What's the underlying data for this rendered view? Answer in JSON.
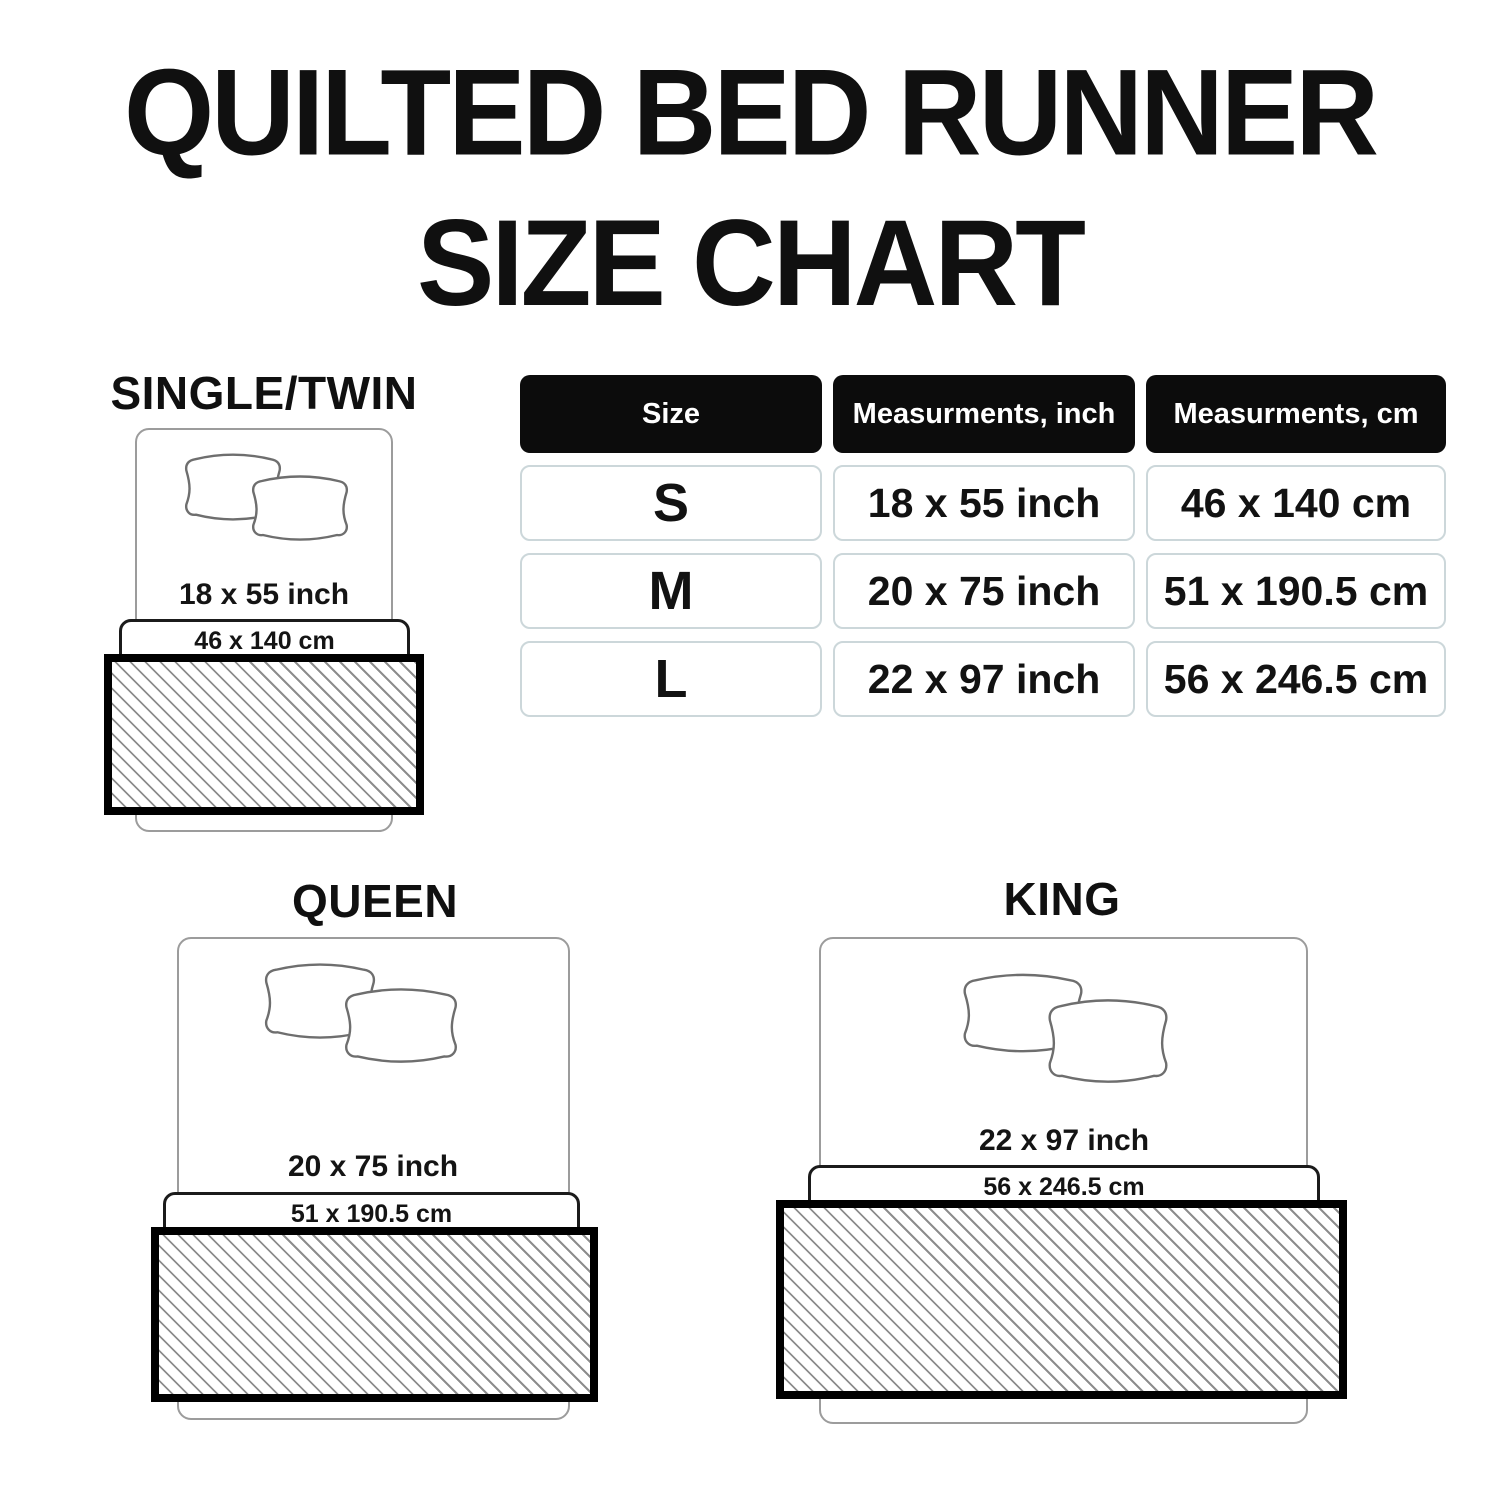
{
  "title": {
    "line1": "QUILTED BED RUNNER",
    "line2": "SIZE CHART"
  },
  "size_table": {
    "headers": [
      "Size",
      "Measurments, inch",
      "Measurments, cm"
    ],
    "rows": [
      {
        "size": "S",
        "inch": "18 x 55 inch",
        "cm": "46 x 140 cm"
      },
      {
        "size": "M",
        "inch": "20 x 75 inch",
        "cm": "51 x 190.5 cm"
      },
      {
        "size": "L",
        "inch": "22 x 97 inch",
        "cm": "56 x 246.5 cm"
      }
    ]
  },
  "diagrams": [
    {
      "label": "SINGLE/TWIN",
      "inch_label": "18 x 55 inch",
      "cm_label": "46 x 140 cm"
    },
    {
      "label": "QUEEN",
      "inch_label": "20 x 75 inch",
      "cm_label": "51 x 190.5 cm"
    },
    {
      "label": "KING",
      "inch_label": "22 x 97 inch",
      "cm_label": "56 x 246.5 cm"
    }
  ],
  "colors": {
    "text": "#101010",
    "header_bg": "#0c0c0c",
    "header_text": "#ffffff",
    "cell_border": "#ccd7da",
    "bed_outline": "#9c9c9c",
    "cm_box_border": "#1b1b1b",
    "runner_border": "#000000",
    "hatch_line": "#8d8d8d"
  },
  "chart_data": {
    "type": "table",
    "title": "QUILTED BED RUNNER SIZE CHART",
    "columns": [
      "Size",
      "Measurments, inch",
      "Measurments, cm"
    ],
    "rows": [
      [
        "S",
        "18 x 55 inch",
        "46 x 140 cm"
      ],
      [
        "M",
        "20 x 75 inch",
        "51 x 190.5 cm"
      ],
      [
        "L",
        "22 x 97 inch",
        "56 x 246.5 cm"
      ]
    ],
    "bed_types": [
      {
        "name": "SINGLE/TWIN",
        "runner_inch": "18 x 55 inch",
        "runner_cm": "46 x 140 cm"
      },
      {
        "name": "QUEEN",
        "runner_inch": "20 x 75 inch",
        "runner_cm": "51 x 190.5 cm"
      },
      {
        "name": "KING",
        "runner_inch": "22 x 97 inch",
        "runner_cm": "56 x 246.5 cm"
      }
    ]
  }
}
